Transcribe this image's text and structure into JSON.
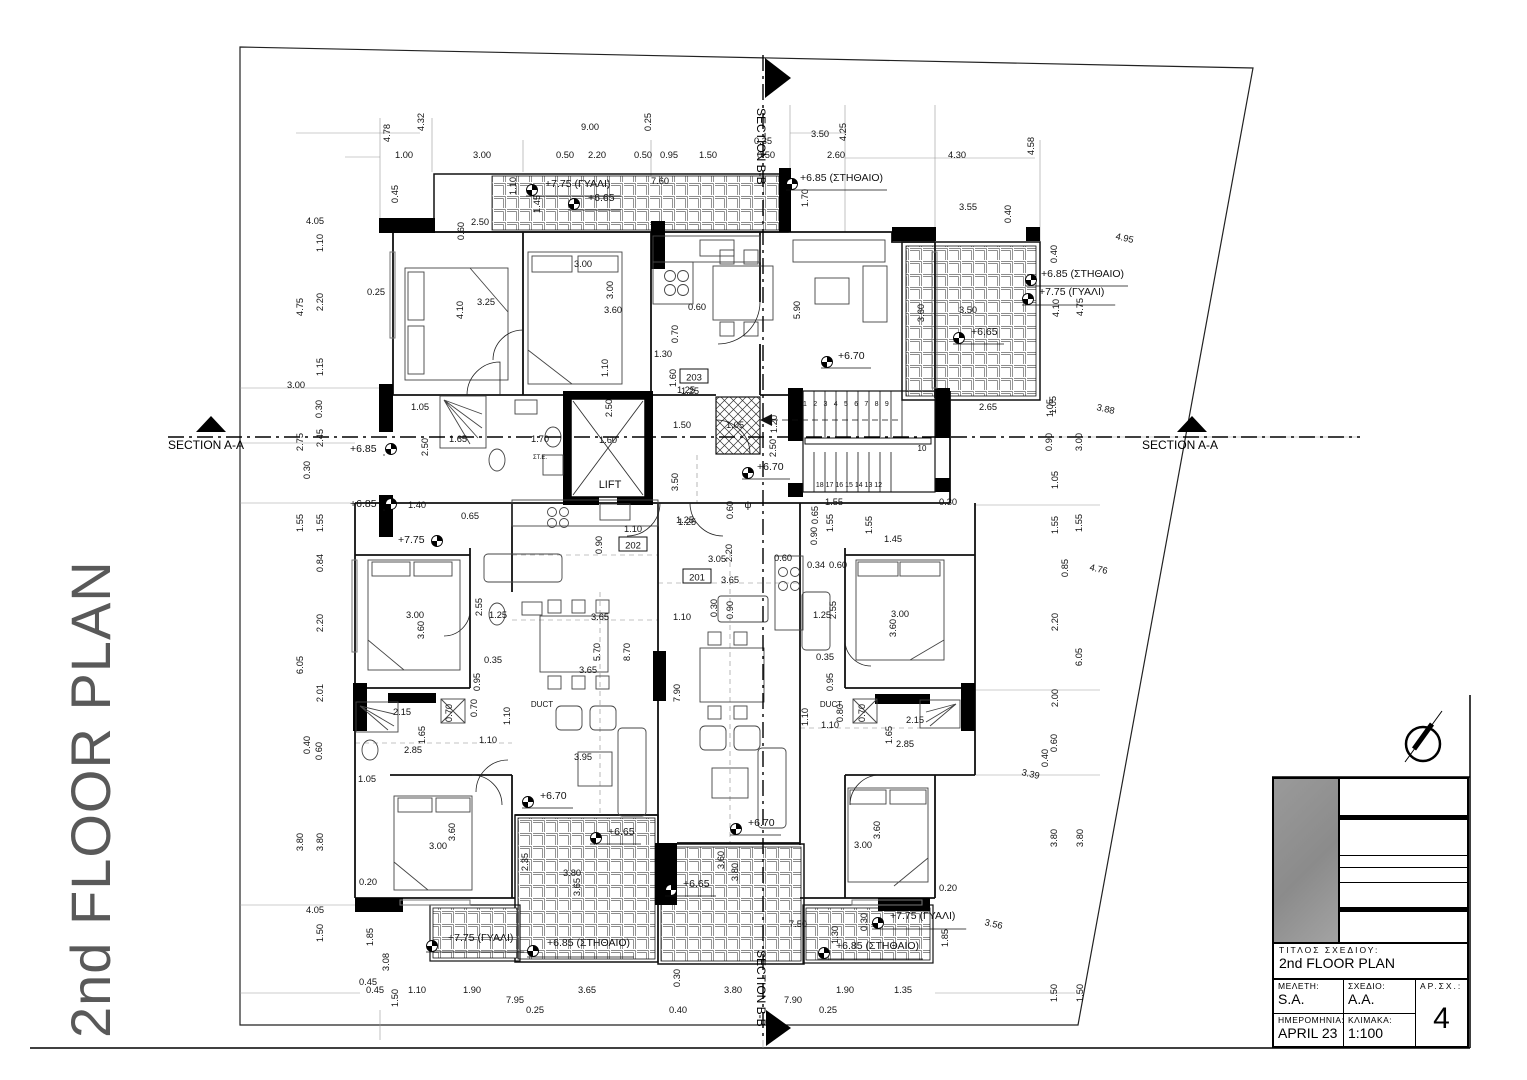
{
  "sheet": {
    "vertical_title": "2nd FLOOR PLAN"
  },
  "sections": {
    "aa": "SECTION A-A",
    "bb": "SECTION B-B"
  },
  "stairs": {
    "top_numbers": "1 2 3 4 5 6 7 8 9",
    "bottom_numbers": "18 17 16 15 14 13 12",
    "landing_number": "10"
  },
  "compass": {
    "name": "north-arrow"
  },
  "title_block": {
    "title_label": "ΤΙΤΛΟΣ ΣΧΕΔΙΟΥ:",
    "title_value": "2nd FLOOR PLAN",
    "meleti_label": "ΜΕΛΕΤΗ:",
    "meleti_value": "S.A.",
    "sxedio_label": "ΣΧΕΔΙΟ:",
    "sxedio_value": "A.A.",
    "arsx_label": "ΑΡ.ΣΧ.:",
    "arsx_value": "4",
    "date_label": "ΗΜΕΡΟΜΗΝΙΑ:",
    "date_value": "APRIL 23",
    "scale_label": "ΚΛΙΜΑΚΑ:",
    "scale_value": "1:100"
  },
  "annotations": {
    "rooms": [
      [
        "203",
        694,
        378
      ],
      [
        "202",
        633,
        546
      ],
      [
        "201",
        697,
        578
      ]
    ],
    "labels": [
      [
        "LIFT",
        610,
        488,
        11,
        0
      ],
      [
        "DUCT",
        542,
        707,
        8,
        0
      ],
      [
        "DUCT",
        831,
        707,
        8,
        0
      ],
      [
        "ψ",
        748,
        508,
        10,
        0
      ],
      [
        "ΣΤ.Ε.",
        540,
        459,
        6,
        0
      ]
    ],
    "levels": [
      [
        "+7.75 (ΓΥΑΛΙ)",
        545,
        187,
        532,
        190
      ],
      [
        "+6.65",
        588,
        201,
        574,
        204
      ],
      [
        "+6.85 (ΣΤΗΘΑΙΟ)",
        800,
        181,
        792,
        184
      ],
      [
        "+6.85 (ΣΤΗΘΑΙΟ)",
        1041,
        277,
        1031,
        280
      ],
      [
        "+7.75 (ΓΥΑΛΙ)",
        1039,
        295,
        1028,
        299
      ],
      [
        "+6.65",
        971,
        335,
        959,
        338
      ],
      [
        "+6.70",
        838,
        359,
        827,
        362
      ],
      [
        "+6.85",
        350,
        452,
        391,
        449
      ],
      [
        "+6.85",
        350,
        507,
        391,
        504
      ],
      [
        "+7.75",
        398,
        543,
        437,
        541
      ],
      [
        "+6.70",
        757,
        470,
        748,
        473
      ],
      [
        "+6.70",
        540,
        799,
        528,
        802
      ],
      [
        "+6.65",
        608,
        835,
        596,
        838
      ],
      [
        "+6.70",
        748,
        826,
        736,
        829
      ],
      [
        "+6.65",
        683,
        887,
        671,
        890
      ],
      [
        "+7.75 (ΓΥΑΛΙ)",
        448,
        941,
        432,
        946
      ],
      [
        "+6.85 (ΣΤΗΘΑΙΟ)",
        547,
        946,
        533,
        951
      ],
      [
        "+7.75 (ΓΥΑΛΙ)",
        890,
        919,
        878,
        923
      ],
      [
        "+6.85 (ΣΤΗΘΑΙΟ)",
        836,
        949,
        824,
        953
      ]
    ],
    "dims": [
      [
        "4.78",
        390,
        133,
        -90
      ],
      [
        "4.32",
        424,
        122,
        -90
      ],
      [
        "9.00",
        590,
        130,
        0
      ],
      [
        "0.25",
        651,
        122,
        -90
      ],
      [
        "4.25",
        846,
        132,
        -90
      ],
      [
        "3.50",
        820,
        137,
        0
      ],
      [
        "0.35",
        763,
        144,
        0
      ],
      [
        "1.00",
        404,
        158,
        0
      ],
      [
        "3.00",
        482,
        158,
        0
      ],
      [
        "0.50",
        565,
        158,
        0
      ],
      [
        "2.20",
        597,
        158,
        0
      ],
      [
        "0.50",
        643,
        158,
        0
      ],
      [
        "0.95",
        669,
        158,
        0
      ],
      [
        "1.50",
        708,
        158,
        0
      ],
      [
        "0.50",
        766,
        158,
        0
      ],
      [
        "2.60",
        836,
        158,
        0
      ],
      [
        "4.30",
        957,
        158,
        0
      ],
      [
        "4.58",
        1034,
        146,
        -90
      ],
      [
        "1.70",
        808,
        198,
        -90
      ],
      [
        "7.60",
        660,
        184,
        0
      ],
      [
        "1.10",
        516,
        186,
        -90
      ],
      [
        "1.45",
        540,
        204,
        -90
      ],
      [
        "0.45",
        398,
        194,
        -90
      ],
      [
        "3.55",
        968,
        210,
        0
      ],
      [
        "0.40",
        1011,
        214,
        -90
      ],
      [
        "4.95",
        1124,
        241,
        13
      ],
      [
        "0.40",
        1057,
        254,
        -90
      ],
      [
        "2.50",
        480,
        225,
        0
      ],
      [
        "0.60",
        464,
        231,
        -90
      ],
      [
        "3.25",
        486,
        305,
        0
      ],
      [
        "4.10",
        463,
        310,
        -90
      ],
      [
        "3.00",
        583,
        267,
        0
      ],
      [
        "3.00",
        613,
        290,
        -90
      ],
      [
        "3.60",
        613,
        313,
        0
      ],
      [
        "0.60",
        697,
        310,
        0
      ],
      [
        "0.70",
        678,
        334,
        -90
      ],
      [
        "1.30",
        663,
        357,
        0
      ],
      [
        "1.10",
        608,
        368,
        -90
      ],
      [
        "1.60",
        676,
        378,
        -90
      ],
      [
        "1.25",
        690,
        394,
        0
      ],
      [
        "5.90",
        800,
        310,
        -90
      ],
      [
        "4.10",
        1059,
        308,
        -90
      ],
      [
        "4.75",
        1083,
        307,
        -90
      ],
      [
        "3.50",
        968,
        313,
        0
      ],
      [
        "3.60",
        924,
        313,
        -90
      ],
      [
        "2.65",
        988,
        410,
        0
      ],
      [
        "1.05",
        1056,
        405,
        -90
      ],
      [
        "3.88",
        1105,
        412,
        13
      ],
      [
        "4.05",
        315,
        224,
        0
      ],
      [
        "1.10",
        323,
        243,
        -90
      ],
      [
        "4.75",
        303,
        307,
        -90
      ],
      [
        "2.20",
        323,
        302,
        -90
      ],
      [
        "0.25",
        376,
        295,
        0
      ],
      [
        "1.15",
        323,
        367,
        -90
      ],
      [
        "3.00",
        296,
        388,
        0
      ],
      [
        "0.30",
        322,
        409,
        -90
      ],
      [
        "2.75",
        303,
        442,
        -90
      ],
      [
        "2.45",
        323,
        438,
        -90
      ],
      [
        "0.30",
        310,
        470,
        -90
      ],
      [
        "1.55",
        303,
        523,
        -90
      ],
      [
        "1.55",
        323,
        523,
        -90
      ],
      [
        "0.84",
        323,
        563,
        -90
      ],
      [
        "2.20",
        323,
        623,
        -90
      ],
      [
        "6.05",
        303,
        665,
        -90
      ],
      [
        "2.01",
        323,
        693,
        -90
      ],
      [
        "0.40",
        310,
        745,
        -90
      ],
      [
        "0.60",
        322,
        751,
        -90
      ],
      [
        "1.05",
        367,
        782,
        0
      ],
      [
        "3.80",
        303,
        842,
        -90
      ],
      [
        "3.80",
        323,
        842,
        -90
      ],
      [
        "0.20",
        368,
        885,
        0
      ],
      [
        "4.05",
        315,
        913,
        0
      ],
      [
        "1.50",
        323,
        933,
        -90
      ],
      [
        "1.85",
        373,
        937,
        -90
      ],
      [
        "0.45",
        368,
        985,
        0
      ],
      [
        "3.08",
        389,
        962,
        -90
      ],
      [
        "1.50",
        398,
        998,
        -90
      ],
      [
        "1.05",
        420,
        410,
        0
      ],
      [
        "1.65",
        458,
        442,
        0
      ],
      [
        "1.70",
        540,
        442,
        0
      ],
      [
        "2.50",
        428,
        447,
        -90
      ],
      [
        "2.50",
        612,
        408,
        -90
      ],
      [
        "1.60",
        608,
        443,
        0
      ],
      [
        "1.25",
        686,
        393,
        0
      ],
      [
        "1.50",
        682,
        428,
        0
      ],
      [
        "3.50",
        678,
        482,
        -90
      ],
      [
        "1.25",
        687,
        525,
        0
      ],
      [
        "1.05",
        735,
        428,
        0
      ],
      [
        "1.20",
        777,
        424,
        -90
      ],
      [
        "2.50",
        776,
        448,
        -90
      ],
      [
        "1.40",
        417,
        508,
        0
      ],
      [
        "0.65",
        470,
        519,
        0
      ],
      [
        "0.65",
        818,
        515,
        -90
      ],
      [
        "1.55",
        834,
        505,
        0
      ],
      [
        "1.55",
        833,
        523,
        -90
      ],
      [
        "1.55",
        872,
        525,
        -90
      ],
      [
        "0.90",
        817,
        536,
        -90
      ],
      [
        "1.45",
        893,
        542,
        0
      ],
      [
        "0.30",
        948,
        505,
        0
      ],
      [
        "0.60",
        733,
        510,
        -90
      ],
      [
        "1.10",
        633,
        532,
        0
      ],
      [
        "0.90",
        602,
        545,
        -90
      ],
      [
        "1.25",
        685,
        523,
        0
      ],
      [
        "3.05",
        717,
        562,
        0
      ],
      [
        "2.20",
        732,
        553,
        -90
      ],
      [
        "0.60",
        783,
        561,
        0
      ],
      [
        "3.65",
        730,
        583,
        0
      ],
      [
        "0.90",
        733,
        610,
        -90
      ],
      [
        "0.30",
        717,
        608,
        -90
      ],
      [
        "1.10",
        682,
        620,
        0
      ],
      [
        "3.00",
        415,
        618,
        0
      ],
      [
        "3.60",
        424,
        630,
        -90
      ],
      [
        "2.55",
        482,
        607,
        -90
      ],
      [
        "1.25",
        498,
        618,
        0
      ],
      [
        "3.65",
        600,
        620,
        0
      ],
      [
        "5.70",
        600,
        652,
        -90
      ],
      [
        "8.70",
        630,
        652,
        -90
      ],
      [
        "3.65",
        588,
        673,
        0
      ],
      [
        "0.35",
        493,
        663,
        0
      ],
      [
        "0.95",
        480,
        682,
        -90
      ],
      [
        "0.70",
        477,
        708,
        -90
      ],
      [
        "0.70",
        452,
        713,
        -90
      ],
      [
        "1.10",
        510,
        716,
        -90
      ],
      [
        "2.15",
        402,
        715,
        0
      ],
      [
        "1.65",
        425,
        735,
        -90
      ],
      [
        "2.85",
        413,
        753,
        0
      ],
      [
        "1.10",
        488,
        743,
        0
      ],
      [
        "3.95",
        583,
        760,
        0
      ],
      [
        "7.90",
        680,
        693,
        -90
      ],
      [
        "3.60",
        455,
        832,
        -90
      ],
      [
        "3.00",
        438,
        849,
        0
      ],
      [
        "0.34",
        816,
        568,
        0
      ],
      [
        "0.60",
        838,
        568,
        0
      ],
      [
        "2.55",
        836,
        610,
        -90
      ],
      [
        "1.25",
        822,
        618,
        0
      ],
      [
        "3.00",
        900,
        617,
        0
      ],
      [
        "3.60",
        896,
        628,
        -90
      ],
      [
        "0.35",
        825,
        660,
        0
      ],
      [
        "0.95",
        833,
        682,
        -90
      ],
      [
        "0.80",
        843,
        713,
        -90
      ],
      [
        "0.70",
        865,
        713,
        -90
      ],
      [
        "1.10",
        808,
        717,
        -90
      ],
      [
        "1.10",
        830,
        728,
        0
      ],
      [
        "1.65",
        892,
        735,
        -90
      ],
      [
        "2.85",
        905,
        747,
        0
      ],
      [
        "2.15",
        915,
        723,
        0
      ],
      [
        "3.60",
        880,
        830,
        -90
      ],
      [
        "3.00",
        863,
        848,
        0
      ],
      [
        "1.05",
        1053,
        408,
        -90
      ],
      [
        "0.90",
        1052,
        442,
        -90
      ],
      [
        "3.00",
        1082,
        442,
        -90
      ],
      [
        "1.05",
        1058,
        480,
        -90
      ],
      [
        "1.55",
        1058,
        525,
        -90
      ],
      [
        "1.55",
        1082,
        523,
        -90
      ],
      [
        "0.85",
        1068,
        568,
        -90
      ],
      [
        "4.76",
        1098,
        572,
        13
      ],
      [
        "2.20",
        1058,
        622,
        -90
      ],
      [
        "6.05",
        1082,
        657,
        -90
      ],
      [
        "2.00",
        1058,
        698,
        -90
      ],
      [
        "0.60",
        1057,
        743,
        -90
      ],
      [
        "0.40",
        1048,
        758,
        -90
      ],
      [
        "3.39",
        1030,
        777,
        13
      ],
      [
        "3.80",
        1057,
        838,
        -90
      ],
      [
        "3.80",
        1083,
        838,
        -90
      ],
      [
        "1.50",
        1057,
        993,
        -90
      ],
      [
        "1.50",
        1083,
        993,
        -90
      ],
      [
        "3.56",
        993,
        927,
        13
      ],
      [
        "1.85",
        948,
        938,
        -90
      ],
      [
        "0.20",
        948,
        891,
        0
      ],
      [
        "7.50",
        798,
        927,
        0
      ],
      [
        "1.30",
        838,
        935,
        -90
      ],
      [
        "0.30",
        867,
        922,
        -90
      ],
      [
        "2.35",
        528,
        862,
        -90
      ],
      [
        "3.65",
        580,
        887,
        -90
      ],
      [
        "3.80",
        572,
        876,
        0
      ],
      [
        "3.60",
        724,
        860,
        -90
      ],
      [
        "3.80",
        738,
        872,
        -90
      ],
      [
        "0.30",
        680,
        978,
        -90
      ],
      [
        "0.45",
        375,
        993,
        0
      ],
      [
        "1.10",
        417,
        993,
        0
      ],
      [
        "1.90",
        472,
        993,
        0
      ],
      [
        "3.65",
        587,
        993,
        0
      ],
      [
        "3.80",
        733,
        993,
        0
      ],
      [
        "1.90",
        845,
        993,
        0
      ],
      [
        "1.35",
        903,
        993,
        0
      ],
      [
        "7.95",
        515,
        1003,
        0
      ],
      [
        "0.25",
        535,
        1013,
        0
      ],
      [
        "0.40",
        678,
        1013,
        0
      ],
      [
        "0.25",
        828,
        1013,
        0
      ],
      [
        "7.90",
        793,
        1003,
        0
      ]
    ]
  }
}
